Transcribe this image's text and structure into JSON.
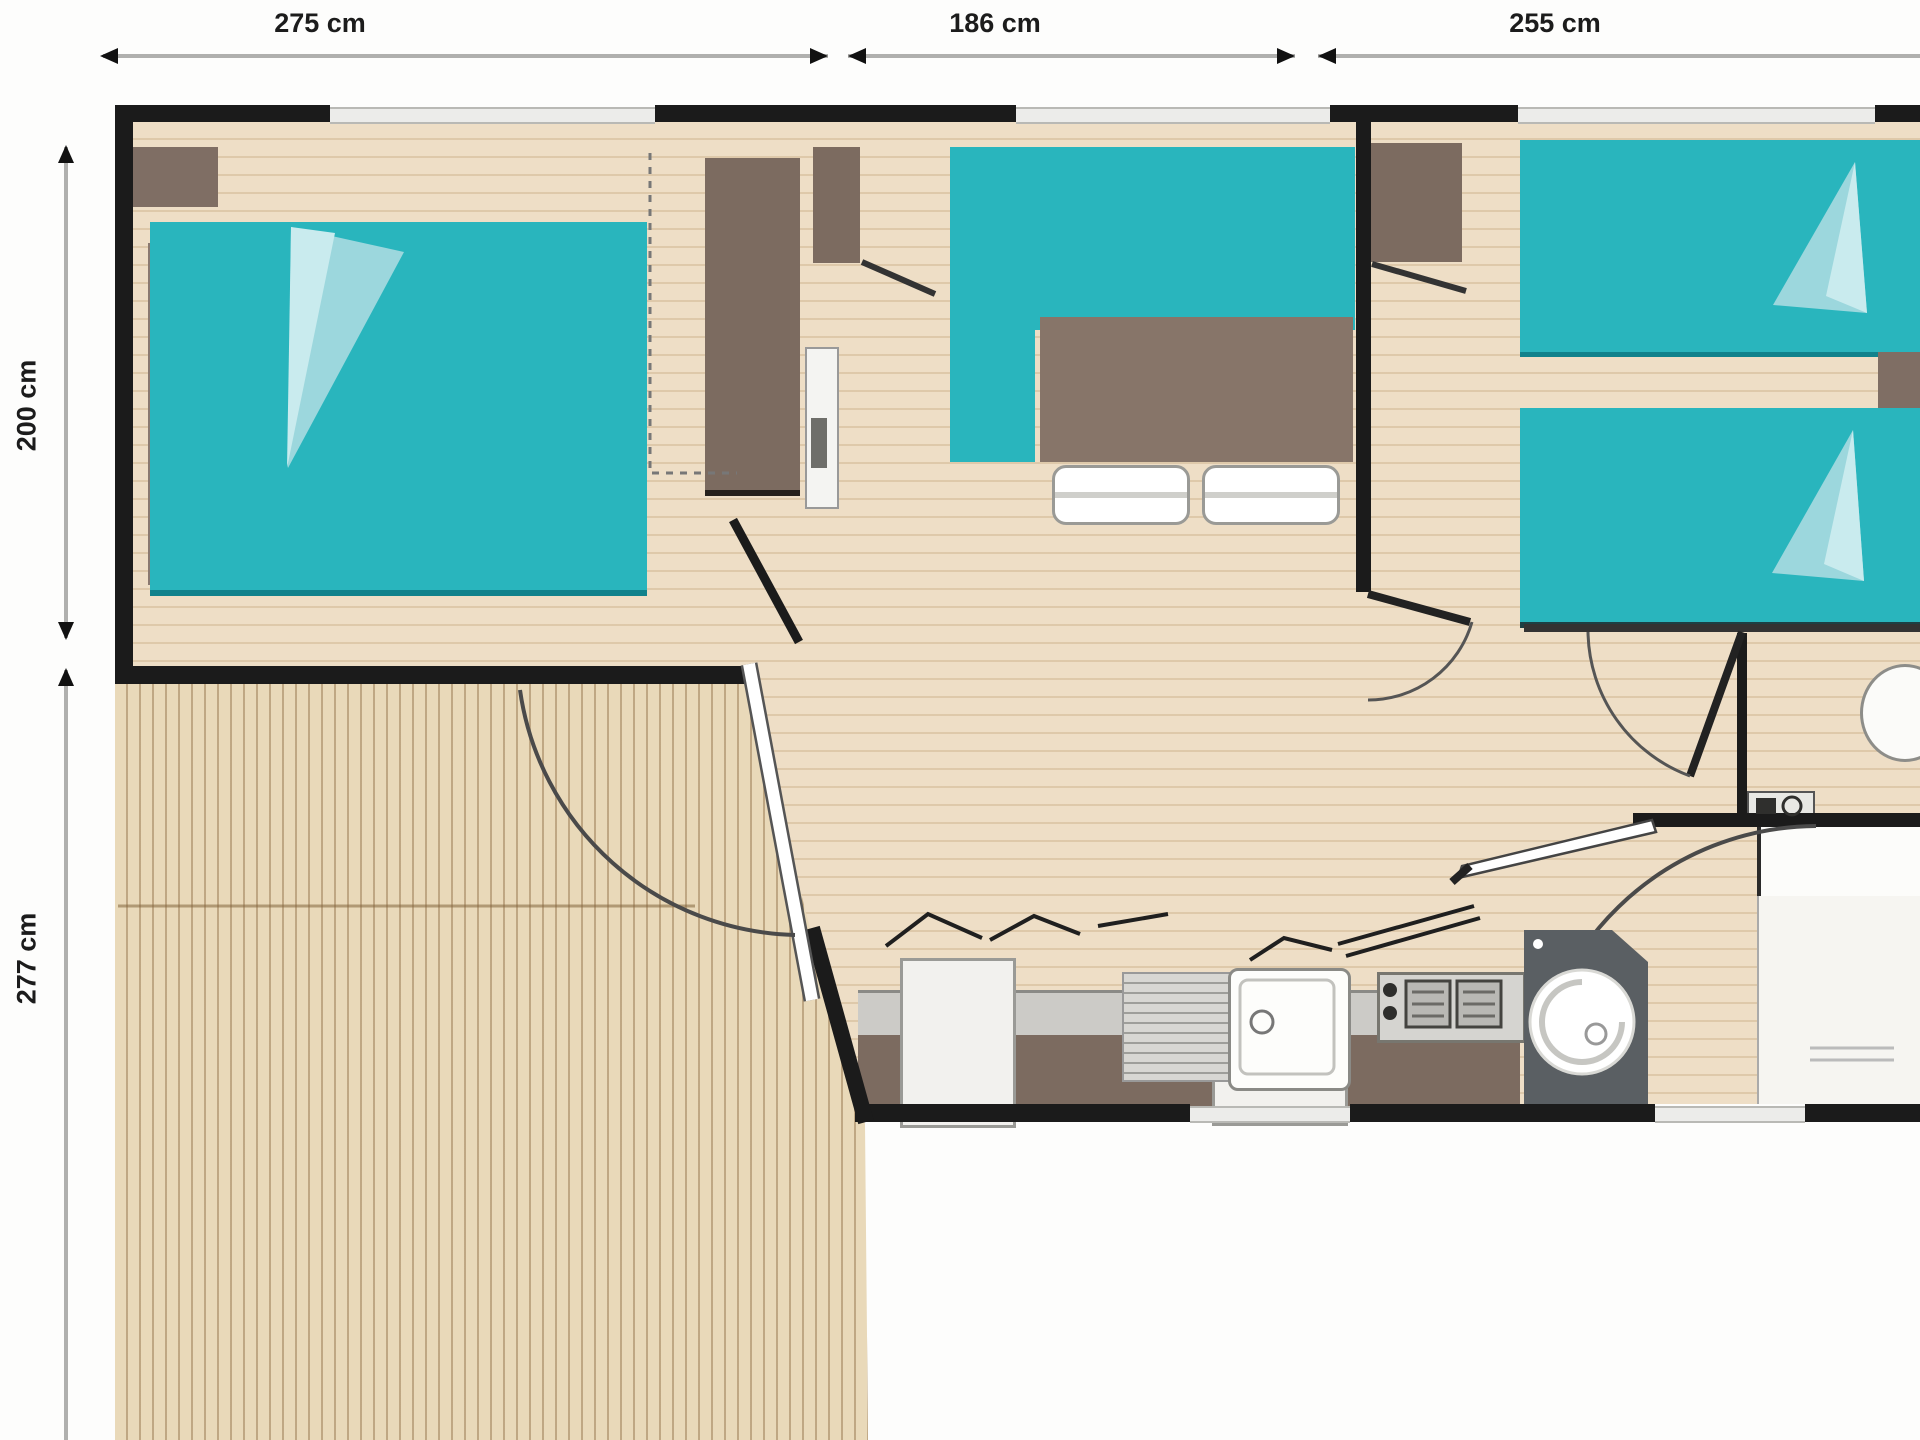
{
  "floor_plan": {
    "type": "mobile-home-floor-plan",
    "dimensions": {
      "top": [
        {
          "label": "275 cm"
        },
        {
          "label": "186 cm"
        },
        {
          "label": "255 cm"
        }
      ],
      "left": [
        {
          "label": "200 cm"
        },
        {
          "label": "277 cm"
        }
      ]
    },
    "rooms": [
      {
        "name": "master-bedroom",
        "furniture": [
          "double-bed",
          "wardrobe",
          "side-shelf",
          "corner-cabinet"
        ]
      },
      {
        "name": "living-dining",
        "furniture": [
          "corner-sofa",
          "dining-table",
          "chairs",
          "wardrobe",
          "water-heater"
        ]
      },
      {
        "name": "kitchen",
        "furniture": [
          "counter",
          "drainboard",
          "sink",
          "stove",
          "cabinets",
          "appliance"
        ]
      },
      {
        "name": "twin-bedroom",
        "furniture": [
          "twin-bed",
          "twin-bed",
          "nightstand",
          "wardrobe"
        ]
      },
      {
        "name": "wc",
        "furniture": [
          "toilet",
          "hand-basin"
        ]
      },
      {
        "name": "bathroom",
        "furniture": [
          "corner-vanity",
          "round-sink",
          "shower"
        ]
      },
      {
        "name": "deck",
        "furniture": []
      }
    ],
    "colors": {
      "bed_teal": "#29b5bd",
      "bed_teal_dark": "#0f7f89",
      "fold_light": "#9cd7dd",
      "furniture_brown": "#7c6b60",
      "wall_black": "#1b1b1b",
      "floor_beige": "#eedec6",
      "deck_beige": "#e9d9b9",
      "counter_gray": "#cccbc7"
    }
  }
}
